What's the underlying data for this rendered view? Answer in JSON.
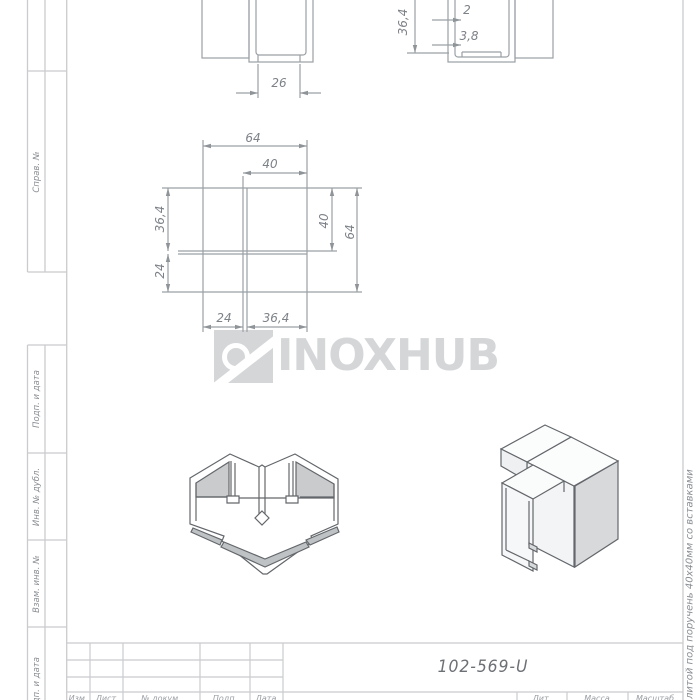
{
  "watermark": {
    "brand": "INOXHUB"
  },
  "dimensions": {
    "section_left_view": {
      "width_26": "26"
    },
    "section_right_view": {
      "height_364": "36,4",
      "wall_2": "2",
      "wall_38": "3,8"
    },
    "plan_view": {
      "top_64": "64",
      "top_40": "40",
      "left_364": "36,4",
      "left_24": "24",
      "right_40": "40",
      "right_64": "64",
      "bottom_24": "24",
      "bottom_364": "36,4"
    }
  },
  "margin_labels": {
    "sprav_n": "Справ. №",
    "podp_i_data_upper": "Подп. и дата",
    "inv_n_dubl": "Инв. № дубл.",
    "vzam_inv_n": "Взам. инв. №",
    "podp_i_data_lower": "Подп. и дата"
  },
  "side_note": "ой литой под поручень 40х40мм со вставками",
  "title_block": {
    "designation": "102-569-U",
    "lit": "Лит.",
    "massa": "Масса",
    "masshtab": "Масштаб",
    "izm": "Изм.",
    "list": "Лист",
    "n_dokum": "№ докум.",
    "podp": "Подп.",
    "data_col": "Дата"
  },
  "colors": {
    "drawing_line": "#9aa0a5",
    "frame_line": "#c9cbce",
    "dim_text": "#7d8288",
    "watermark": "#d4d6d8",
    "iso_line": "#63676b",
    "iso_shade": "#c9cbcd"
  }
}
